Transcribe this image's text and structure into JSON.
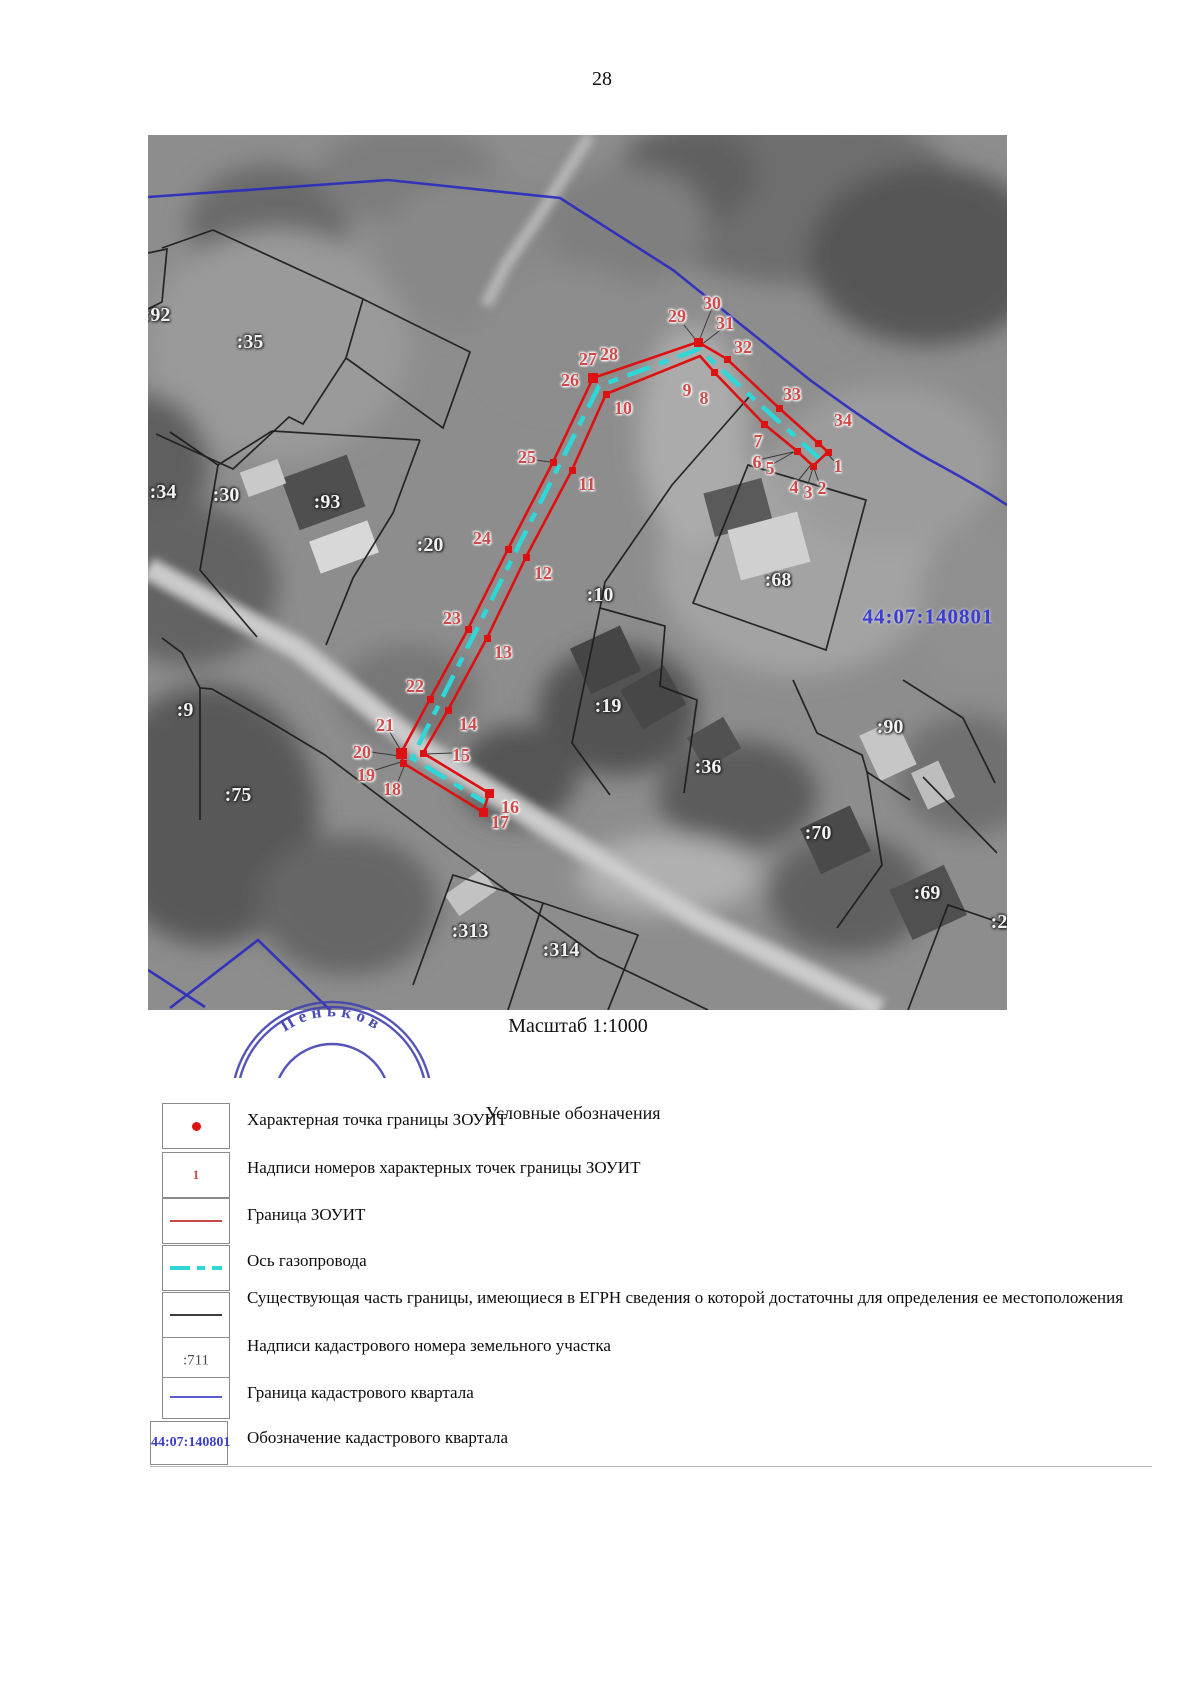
{
  "page": {
    "number": "28"
  },
  "map": {
    "scale_caption": "Масштаб 1:1000",
    "quarter_label": "44:07:140801",
    "stamp_text": "Пеньков",
    "colors": {
      "zouit_boundary": "#dd1111",
      "gas_axis": "#2fd8d8",
      "quarter_boundary": "#2a2ac0",
      "parcel_boundary": "#1c1c1c",
      "point_label": "#d04a4a",
      "parcel_label": "#f2f2f2",
      "quarter_label": "#3c3ccf"
    },
    "parcel_labels": [
      {
        "text": ":92",
        "x": 9,
        "y": 180
      },
      {
        "text": ":35",
        "x": 102,
        "y": 207
      },
      {
        "text": ":34",
        "x": 15,
        "y": 357
      },
      {
        "text": ":30",
        "x": 78,
        "y": 360
      },
      {
        "text": ":93",
        "x": 179,
        "y": 367
      },
      {
        "text": ":20",
        "x": 282,
        "y": 410
      },
      {
        "text": ":10",
        "x": 452,
        "y": 460
      },
      {
        "text": ":68",
        "x": 630,
        "y": 445
      },
      {
        "text": ":19",
        "x": 460,
        "y": 571
      },
      {
        "text": ":36",
        "x": 560,
        "y": 632
      },
      {
        "text": ":90",
        "x": 742,
        "y": 592
      },
      {
        "text": ":70",
        "x": 670,
        "y": 698
      },
      {
        "text": ":69",
        "x": 779,
        "y": 758
      },
      {
        "text": ":26",
        "x": 856,
        "y": 787
      },
      {
        "text": ":75",
        "x": 90,
        "y": 660
      },
      {
        "text": ":9",
        "x": 37,
        "y": 575
      },
      {
        "text": ":313",
        "x": 322,
        "y": 796
      },
      {
        "text": ":314",
        "x": 413,
        "y": 815
      }
    ],
    "point_labels": [
      {
        "text": "1",
        "x": 690,
        "y": 331
      },
      {
        "text": "2",
        "x": 674,
        "y": 353
      },
      {
        "text": "3",
        "x": 660,
        "y": 357
      },
      {
        "text": "4",
        "x": 646,
        "y": 352
      },
      {
        "text": "5",
        "x": 622,
        "y": 333
      },
      {
        "text": "6",
        "x": 609,
        "y": 327
      },
      {
        "text": "7",
        "x": 610,
        "y": 306
      },
      {
        "text": "8",
        "x": 556,
        "y": 263
      },
      {
        "text": "9",
        "x": 539,
        "y": 255
      },
      {
        "text": "10",
        "x": 475,
        "y": 273
      },
      {
        "text": "11",
        "x": 439,
        "y": 349
      },
      {
        "text": "12",
        "x": 395,
        "y": 438
      },
      {
        "text": "13",
        "x": 355,
        "y": 517
      },
      {
        "text": "14",
        "x": 320,
        "y": 589
      },
      {
        "text": "15",
        "x": 313,
        "y": 620
      },
      {
        "text": "16",
        "x": 362,
        "y": 672
      },
      {
        "text": "17",
        "x": 352,
        "y": 687
      },
      {
        "text": "18",
        "x": 244,
        "y": 654
      },
      {
        "text": "19",
        "x": 218,
        "y": 640
      },
      {
        "text": "20",
        "x": 214,
        "y": 617
      },
      {
        "text": "21",
        "x": 237,
        "y": 590
      },
      {
        "text": "22",
        "x": 267,
        "y": 551
      },
      {
        "text": "23",
        "x": 304,
        "y": 483
      },
      {
        "text": "24",
        "x": 334,
        "y": 403
      },
      {
        "text": "25",
        "x": 379,
        "y": 322
      },
      {
        "text": "26",
        "x": 422,
        "y": 245
      },
      {
        "text": "27",
        "x": 440,
        "y": 224
      },
      {
        "text": "28",
        "x": 461,
        "y": 219
      },
      {
        "text": "29",
        "x": 529,
        "y": 181
      },
      {
        "text": "30",
        "x": 564,
        "y": 168
      },
      {
        "text": "31",
        "x": 577,
        "y": 188
      },
      {
        "text": "32",
        "x": 595,
        "y": 212
      },
      {
        "text": "33",
        "x": 644,
        "y": 259
      },
      {
        "text": "34",
        "x": 695,
        "y": 285
      }
    ]
  },
  "legend": {
    "title": "Условные обозначения",
    "items": [
      {
        "symbol": "red-point",
        "label": "Характерная точка границы ЗОУИТ"
      },
      {
        "symbol": "point-number",
        "symbol_text": "1",
        "label": "Надписи номеров характерных точек границы ЗОУИТ"
      },
      {
        "symbol": "red-line",
        "label": "Граница ЗОУИТ"
      },
      {
        "symbol": "cyan-dashed-line",
        "label": "Ось газопровода"
      },
      {
        "symbol": "black-line",
        "label": "Существующая часть границы, имеющиеся в ЕГРН сведения о которой достаточны для определения ее местоположения"
      },
      {
        "symbol": "parcel-number",
        "symbol_text": ":711",
        "label": "Надписи кадастрового номера земельного участка"
      },
      {
        "symbol": "blue-line",
        "label": "Граница кадастрового квартала"
      },
      {
        "symbol": "quarter-number",
        "symbol_text": "44:07:140801",
        "label": "Обозначение кадастрового квартала"
      }
    ]
  }
}
